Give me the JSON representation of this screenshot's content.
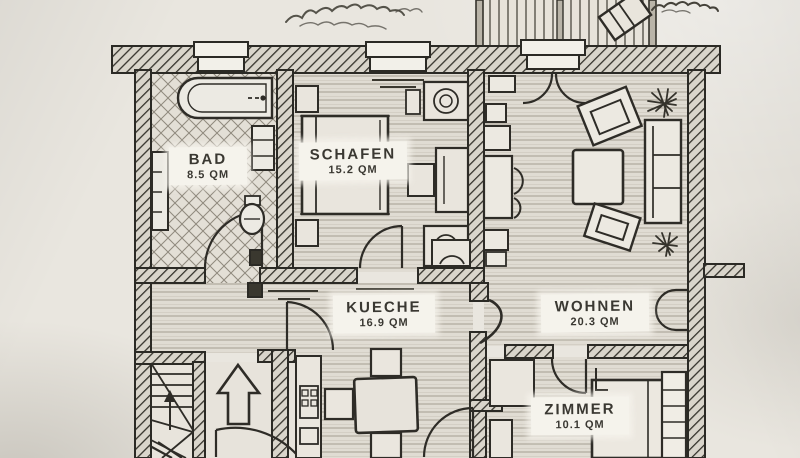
{
  "plan": {
    "rooms": [
      {
        "id": "bad",
        "name": "BAD",
        "area": "8.5 QM"
      },
      {
        "id": "schafen",
        "name": "SCHAFEN",
        "area": "15.2 QM"
      },
      {
        "id": "kueche",
        "name": "KUECHE",
        "area": "16.9 QM"
      },
      {
        "id": "wohnen",
        "name": "WOHNEN",
        "area": "20.3 QM"
      },
      {
        "id": "zimmer",
        "name": "ZIMMER",
        "area": "10.1 QM"
      }
    ],
    "colors": {
      "paper": "#e9e6df",
      "ink": "#2e2c27",
      "floor": "#e0dcd3",
      "label_bg": "#f5f3ec"
    }
  }
}
